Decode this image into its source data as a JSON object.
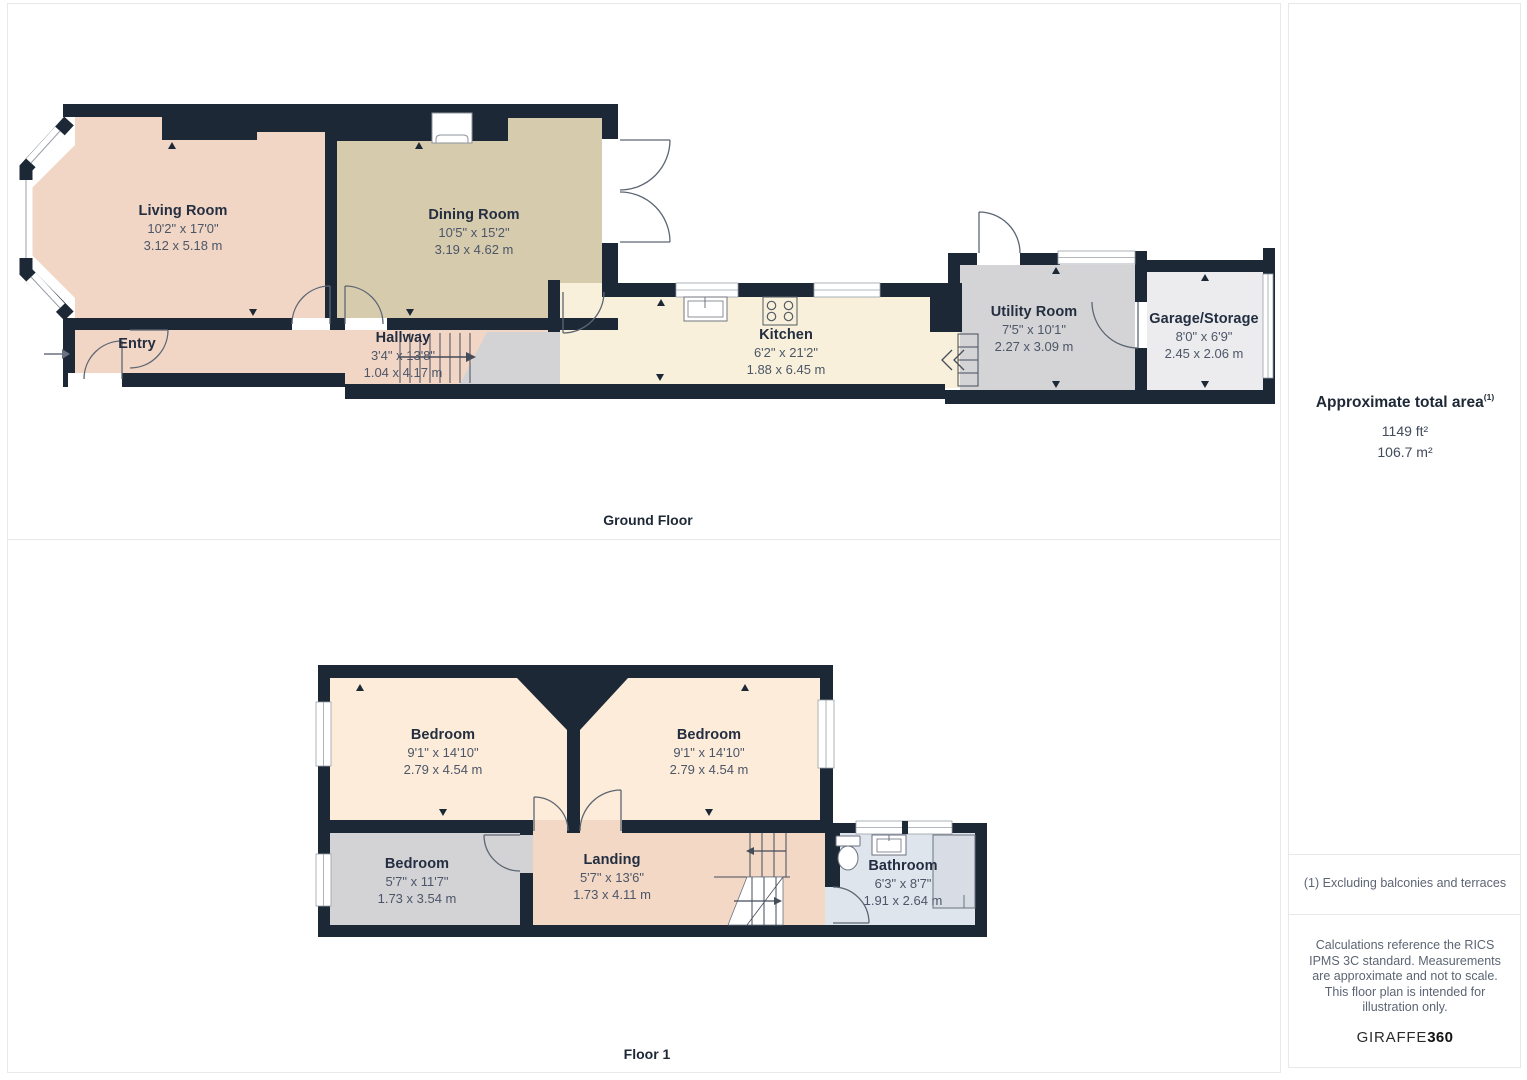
{
  "panels": {
    "ground_floor": {
      "label": "Ground Floor",
      "rooms": [
        {
          "name": "Living Room",
          "dims_ft": "10'2\" x 17'0\"",
          "dims_m": "3.12 x 5.18 m"
        },
        {
          "name": "Dining Room",
          "dims_ft": "10'5\" x 15'2\"",
          "dims_m": "3.19 x 4.62 m"
        },
        {
          "name": "Entry",
          "dims_ft": "",
          "dims_m": ""
        },
        {
          "name": "Hallway",
          "dims_ft": "3'4\" x 13'8\"",
          "dims_m": "1.04 x 4.17 m"
        },
        {
          "name": "Kitchen",
          "dims_ft": "6'2\" x 21'2\"",
          "dims_m": "1.88 x 6.45 m"
        },
        {
          "name": "Utility Room",
          "dims_ft": "7'5\" x 10'1\"",
          "dims_m": "2.27 x 3.09 m"
        },
        {
          "name": "Garage/Storage",
          "dims_ft": "8'0\" x 6'9\"",
          "dims_m": "2.45 x 2.06 m"
        }
      ]
    },
    "floor_1": {
      "label": "Floor 1",
      "rooms": [
        {
          "name": "Bedroom",
          "dims_ft": "9'1\" x 14'10\"",
          "dims_m": "2.79 x 4.54 m"
        },
        {
          "name": "Bedroom",
          "dims_ft": "9'1\" x 14'10\"",
          "dims_m": "2.79 x 4.54 m"
        },
        {
          "name": "Bedroom",
          "dims_ft": "5'7\" x 11'7\"",
          "dims_m": "1.73 x 3.54 m"
        },
        {
          "name": "Landing",
          "dims_ft": "5'7\" x 13'6\"",
          "dims_m": "1.73 x 4.11 m"
        },
        {
          "name": "Bathroom",
          "dims_ft": "6'3\" x 8'7\"",
          "dims_m": "1.91 x 2.64 m"
        }
      ]
    }
  },
  "sidebar": {
    "total_area_title": "Approximate total area",
    "total_area_footnote_marker": "(1)",
    "area_ft": "1149 ft²",
    "area_m": "106.7 m²",
    "footnote": "(1) Excluding balconies and terraces",
    "disclaimer": "Calculations reference the RICS IPMS 3C standard. Measurements are approximate and not to scale. This floor plan is intended for illustration only.",
    "brand_name": "GIRAFFE",
    "brand_suffix": "360"
  },
  "colors": {
    "wall": "#1d2836",
    "living_room": "#f2d6c5",
    "dining_room": "#d7cbae",
    "kitchen": "#f8f0da",
    "utility_room": "#d4d4d6",
    "garage": "#ececee",
    "bedroom": "#fdecd9",
    "landing": "#f3d8c6",
    "bedroom_small": "#d3d3d5",
    "bathroom": "#dfe5ed",
    "room_name_text": "#232e40",
    "dimension_text": "#4c5668",
    "panel_border": "#e7e8ea"
  }
}
